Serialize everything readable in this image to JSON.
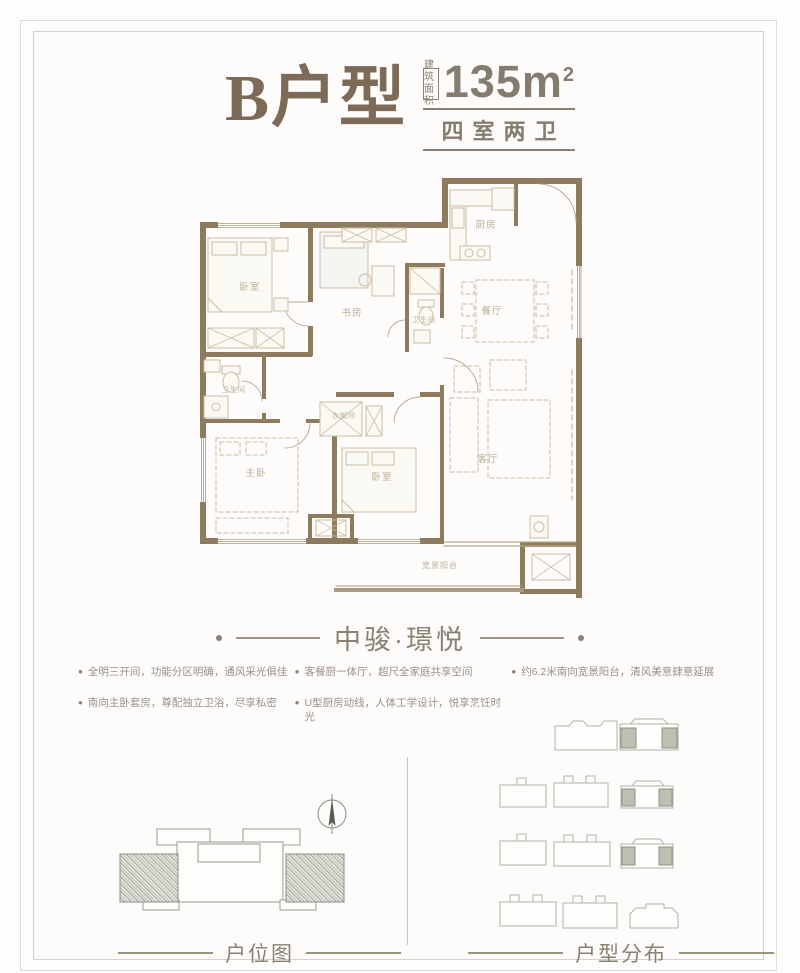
{
  "header": {
    "title": "B户型",
    "badge_line1": "建筑",
    "badge_line2": "面积",
    "area_value": "135",
    "area_unit": "m",
    "area_sup": "2",
    "subtitle": "四室两卫"
  },
  "brand": {
    "name": "中骏·璟悦"
  },
  "features": {
    "col1": [
      "全明三开间，功能分区明确，通风采光俱佳",
      "南向主卧套房，尊配独立卫浴，尽享私密"
    ],
    "col2": [
      "客餐厨一体厅，超尺全家庭共享空间",
      "U型厨房动线，人体工学设计，悦享烹饪时光"
    ],
    "col3": [
      "约6.2米南向宽景阳台，清风美意肆意延展"
    ]
  },
  "floorplan": {
    "rooms": {
      "bed1": "卧室",
      "study": "书房",
      "bath1": "卫生间",
      "bath2": "卫生间",
      "closet": "衣帽间",
      "master": "主卧",
      "bed3": "卧室",
      "kitchen": "厨房",
      "dining": "餐厅",
      "living": "客厅",
      "balcony": "宽景阳台"
    }
  },
  "footer": {
    "left_caption": "户位图",
    "right_caption": "户型分布"
  },
  "colors": {
    "title_brown": "#7d6b57",
    "text_brown": "#8b8072",
    "wall": "#8d7a5f",
    "furniture_line": "#cbbda2",
    "highlight_block": "#bcc0b1"
  }
}
